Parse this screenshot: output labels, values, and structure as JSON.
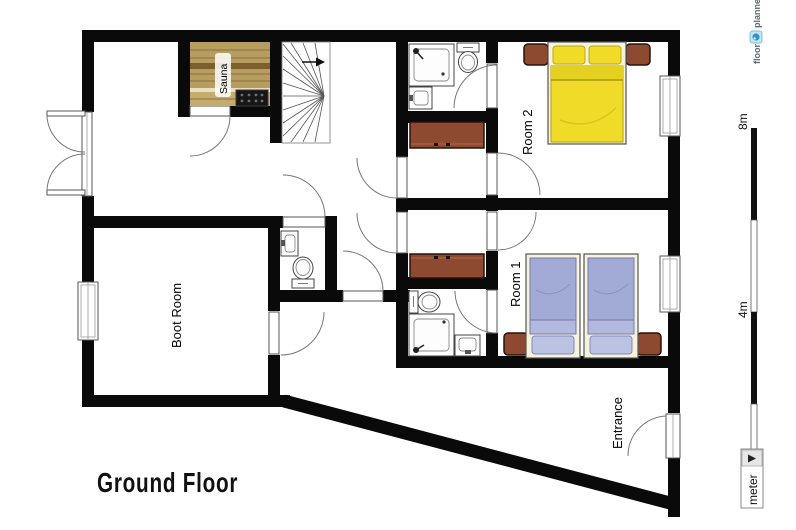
{
  "logo": {
    "word1": "floor",
    "word2": "planner"
  },
  "plan": {
    "title": "Ground Floor",
    "rooms": {
      "sauna": "Sauna",
      "boot_room": "Boot Room",
      "room1": "Room 1",
      "room2": "Room 2",
      "entrance": "Entrance"
    }
  },
  "scale_bar": {
    "label_top": "8m",
    "label_mid": "4m"
  },
  "unit_selector": {
    "value": "meter"
  },
  "colors": {
    "wall": "#0a0a0a",
    "sauna_wood": "#b79d60",
    "wardrobe_brown": "#8d4a30",
    "bed_yellow": "#f0dc28",
    "bed_blue": "#a2aad6",
    "bed_frame": "#f6f2dd",
    "logo_blue": "#2b96cf"
  }
}
